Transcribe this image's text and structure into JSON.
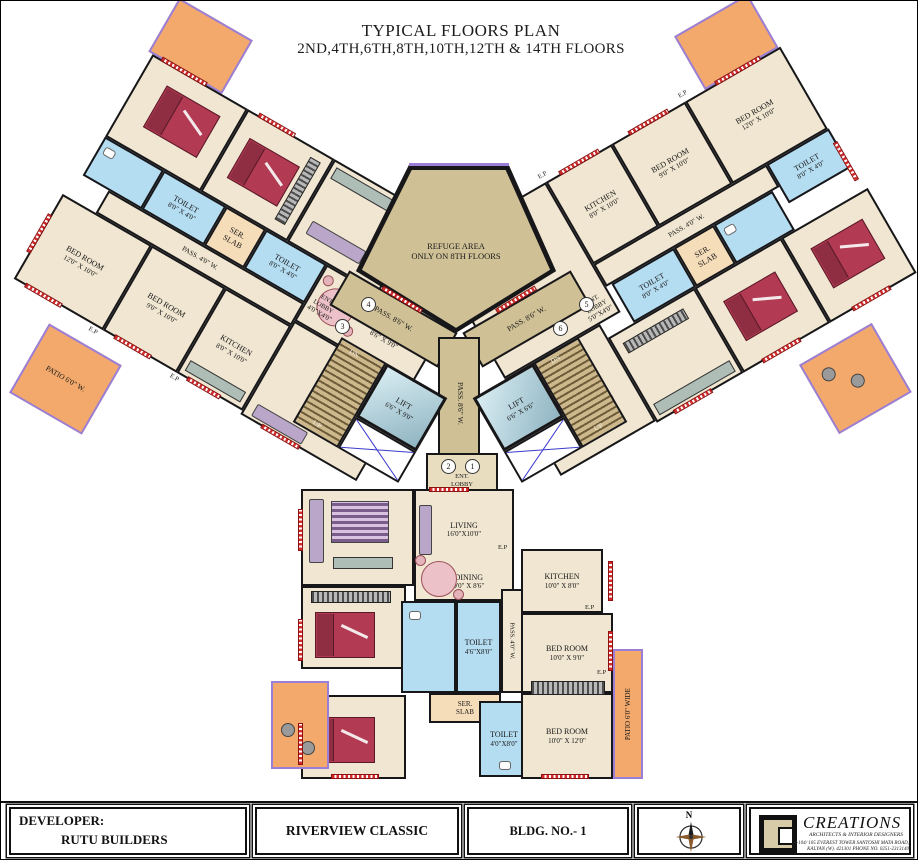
{
  "title": {
    "line1": "TYPICAL FLOORS PLAN",
    "line2": "2ND,4TH,6TH,8TH,10TH,12TH & 14TH FLOORS"
  },
  "center": {
    "refuge_line1": "REFUGE AREA",
    "refuge_line2": "ONLY ON 8TH FLOORS",
    "pass_main": "PASS. 8'6\" W.",
    "lift_left_name": "LIFT",
    "lift_left_dims": "6'6\" X 9'0\"",
    "lift_right_name": "LIFT",
    "lift_right_dims": "6'6\" X 6'6\"",
    "up": "UP",
    "dn": "DN",
    "lobby": {
      "l1": "ENT.",
      "l2": "LOBBY"
    },
    "lobby_left_dims": "4'0\"X4'0\"",
    "lobby_right_dims": "5'0\"X4'0\"",
    "lobby_bottom_dims": "4'0\"X4'0\"",
    "units": {
      "u1": "1",
      "u2": "2",
      "u3": "3",
      "u4": "4",
      "u5": "5",
      "u6": "6"
    }
  },
  "left_wing": {
    "patio_upper": "PATIO 6'0\" W.",
    "patio_lower": "PATIO 6'0\" W.",
    "toilet1": {
      "name": "TOILET",
      "dims": "8'0\" X 4'0\""
    },
    "toilet2": {
      "name": "TOILET",
      "dims": "8'0\" X 4'0\""
    },
    "slab": {
      "l1": "SER.",
      "l2": "SLAB"
    },
    "dining": {
      "name": "DINING",
      "dims": "8'6\" X 9'0\""
    },
    "pass": "PASS. 4'0\" W.",
    "bed12": {
      "name": "BED ROOM",
      "dims": "12'0\" X 10'0\""
    },
    "bed9": {
      "name": "BED ROOM",
      "dims": "9'0\" X 10'0\""
    },
    "kitchen": {
      "name": "KITCHEN",
      "dims": "8'0\" X 10'0\""
    },
    "living": {
      "name": "LIVING",
      "dims": "10'0\" X 16'0\""
    },
    "ep": "E.P"
  },
  "right_wing": {
    "patio_upper": "PATIO 6'0\" W.",
    "patio_lower": "PATIO 6'0\" W.",
    "toilet1": {
      "name": "TOILET",
      "dims": "8'0\" X 4'0\""
    },
    "toilet2": {
      "name": "TOILET",
      "dims": "8'0\" X 4'0\""
    },
    "slab": {
      "l1": "SER.",
      "l2": "SLAB"
    },
    "pass": "PASS. 4'0\" W.",
    "bed12": {
      "name": "BED ROOM",
      "dims": "12'0\" X 10'0\""
    },
    "bed9": {
      "name": "BED ROOM",
      "dims": "9'0\" X 10'0\""
    },
    "kitchen": {
      "name": "KITCHEN",
      "dims": "8'0\" X 10'0\""
    },
    "living": {
      "name": "LIVING",
      "dims": "10'0\" X 16'0\""
    },
    "ep": "E.P"
  },
  "bottom_wing": {
    "living": {
      "name": "LIVING",
      "dims": "16'0\"X10'0\""
    },
    "dining": {
      "name": "DINING",
      "dims": "9'0\" X 8'6\""
    },
    "kitchen": {
      "name": "KITCHEN",
      "dims": "10'0\" X 8'0\""
    },
    "pass": "PASS. 4'0\" W.",
    "toilet1": {
      "name": "TOILET",
      "dims": "4'6\"X8'0\""
    },
    "toilet2": {
      "name": "TOILET",
      "dims": "4'0\"X8'0\""
    },
    "slab": {
      "l1": "SER.",
      "l2": "SLAB"
    },
    "bed1": {
      "name": "BED ROOM",
      "dims": "10'0\" X 9'0\""
    },
    "bed2": {
      "name": "BED ROOM",
      "dims": "10'0\" X 12'0\""
    },
    "patio": "PATIO 6'0\" WIDE",
    "ep": "E.P"
  },
  "footer": {
    "developer_label": "DEVELOPER:",
    "developer_name": "RUTU BUILDERS",
    "project": "RIVERVIEW CLASSIC",
    "building": "BLDG. NO.- 1",
    "compass_n": "N",
    "firm": {
      "name": "CREATIONS",
      "tagline": "ARCHITECTS & INTERIOR DESIGNERS",
      "address1": "A-104/ 105 EVEREST TOWER SANTOSHI MATA ROAD,",
      "address2": "KALYAN (W). 421301  PHONE NO. 0251-2313140"
    }
  },
  "colors": {
    "wall": "#17171a",
    "floor": "#f0e6d1",
    "core": "#cfc096",
    "patio": "#f2a96b",
    "toilet": "#b5ddf2",
    "marker_red": "#d42a2a",
    "patio_edge": "#9b7fd6",
    "bed": "#b23a52",
    "slab": "#f6ddba"
  }
}
